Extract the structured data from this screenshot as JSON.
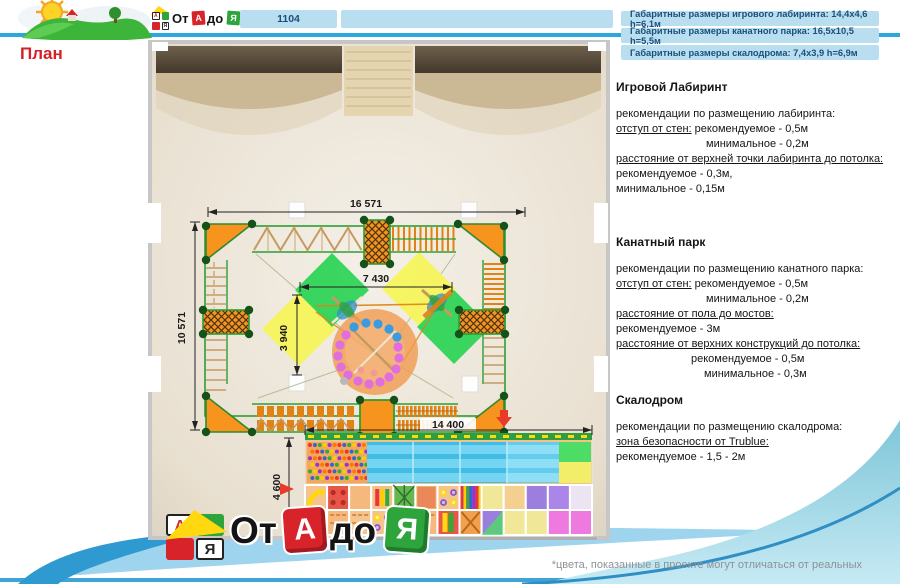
{
  "header": {
    "project_number": "1104",
    "info_boxes": [
      "Габаритные размеры игрового лабиринта: 14,4x4,6 h=6,1м",
      "Габаритные размеры канатного парка: 16,5x10,5 h=5,5м",
      "Габаритные размеры скалодрома: 7,4x3,9 h=6,9м"
    ]
  },
  "page_title": "План",
  "plan": {
    "dims": {
      "top": "16 571",
      "inner_w": "7 430",
      "inner_h": "3 940",
      "left": "10 571",
      "bottom": "14 400",
      "labyrinth_h": "4 600"
    }
  },
  "sections": [
    {
      "title": "Игровой Лабиринт",
      "lines": [
        {
          "parts": [
            {
              "t": "рекомендации по размещению лабиринта:"
            }
          ]
        },
        {
          "parts": [
            {
              "t": "отступ от стен:",
              "u": 1
            },
            {
              "t": " рекомендуемое - 0,5м"
            }
          ]
        },
        {
          "indent": 90,
          "parts": [
            {
              "t": "минимальное - 0,2м"
            }
          ]
        },
        {
          "parts": [
            {
              "t": "расстояние от верхней точки лабиринта до потолка:",
              "u": 1
            }
          ]
        },
        {
          "parts": [
            {
              "t": "рекомендуемое - 0,3м,"
            }
          ]
        },
        {
          "parts": [
            {
              "t": "минимальное - 0,15м"
            }
          ]
        }
      ]
    },
    {
      "title": "Канатный парк",
      "lines": [
        {
          "parts": [
            {
              "t": "рекомендации по размещению канатного парка:"
            }
          ]
        },
        {
          "parts": [
            {
              "t": "отступ от стен:",
              "u": 1
            },
            {
              "t": " рекомендуемое - 0,5м"
            }
          ]
        },
        {
          "indent": 90,
          "parts": [
            {
              "t": "минимальное - 0,2м"
            }
          ]
        },
        {
          "parts": [
            {
              "t": "расстояние от пола до мостов:",
              "u": 1
            }
          ]
        },
        {
          "parts": [
            {
              "t": "рекомендуемое - 3м"
            }
          ]
        },
        {
          "parts": [
            {
              "t": "расстояние от верхних конструкций до потолка:",
              "u": 1
            }
          ]
        },
        {
          "indent": 75,
          "parts": [
            {
              "t": "рекомендуемое - 0,5м"
            }
          ]
        },
        {
          "indent": 88,
          "parts": [
            {
              "t": "минимальное - 0,3м"
            }
          ]
        }
      ]
    },
    {
      "title": "Скалодром",
      "lines": [
        {
          "parts": [
            {
              "t": "рекомендации по размещению скалодрома:"
            }
          ]
        },
        {
          "parts": [
            {
              "t": "зона безопасности от Trublue:",
              "u": 1
            }
          ]
        },
        {
          "parts": [
            {
              "t": "рекомендуемое - 1,5 - 2м"
            }
          ]
        }
      ]
    }
  ],
  "logo": {
    "block_a": "А",
    "block_ya": "Я",
    "word_start": "От",
    "cube_a": "А",
    "word_mid": "до",
    "cube_ya": "Я"
  },
  "footer": {
    "note": "*цвета, показанные в проекте могут отличаться от реальных"
  },
  "colors": {
    "accent_line": "#2aa7dd",
    "info_box_bg": "#b9def0",
    "info_box_text": "#1c4f7c",
    "title_red": "#d42027",
    "swoosh_teal": "#8fccdc",
    "frame_green": "#2e9e33",
    "platform_orange": "#f7941d"
  }
}
